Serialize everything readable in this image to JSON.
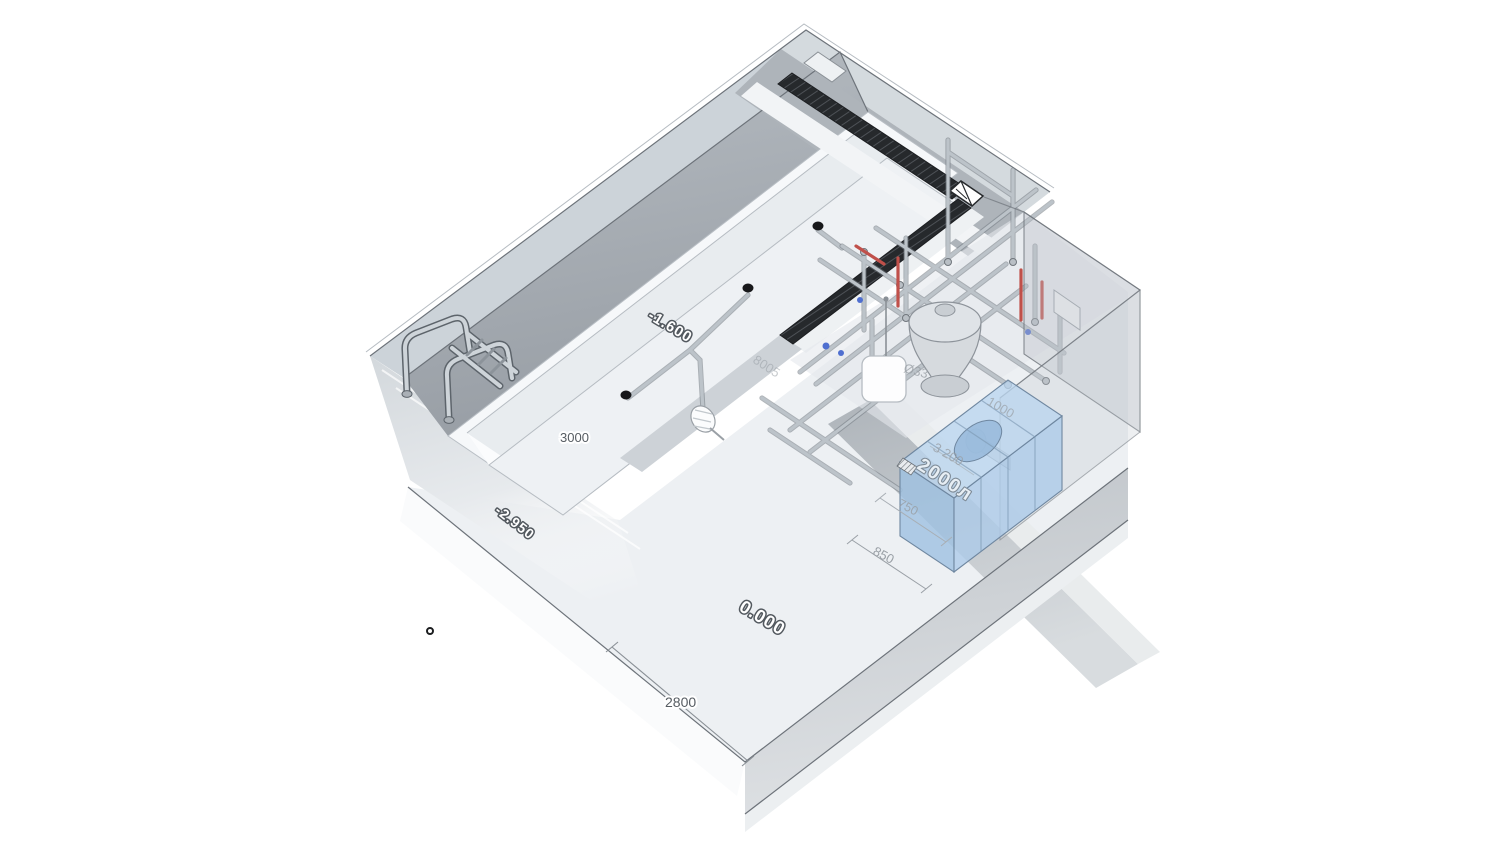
{
  "view": {
    "background": "#ffffff",
    "type": "3d-axonometric-model"
  },
  "levels": {
    "pool_floor": "-1.600",
    "deck": "0.000",
    "foundation": "-2.950"
  },
  "dimensions": {
    "pool_width": "3000",
    "slab_edge": "2800",
    "gutter_length": "8005",
    "tank_step": "850",
    "tank_width": "750",
    "tank_length": "3 200",
    "tank_height": "1000",
    "pipe_diameter": "Ø33"
  },
  "tank": {
    "capacity": "2000л"
  },
  "colors": {
    "structure_light": "#ccd3d9",
    "structure_shadow": "#a6acb2",
    "pool_surface": "#eef1f4",
    "grate_dark": "#26292c",
    "tank_blue": "#aecdea",
    "pipe_gray": "#bcc3c9",
    "pipe_red": "#c0504a",
    "valve_blue": "#4f6fd0",
    "dim_text": "#9aa0a6"
  }
}
